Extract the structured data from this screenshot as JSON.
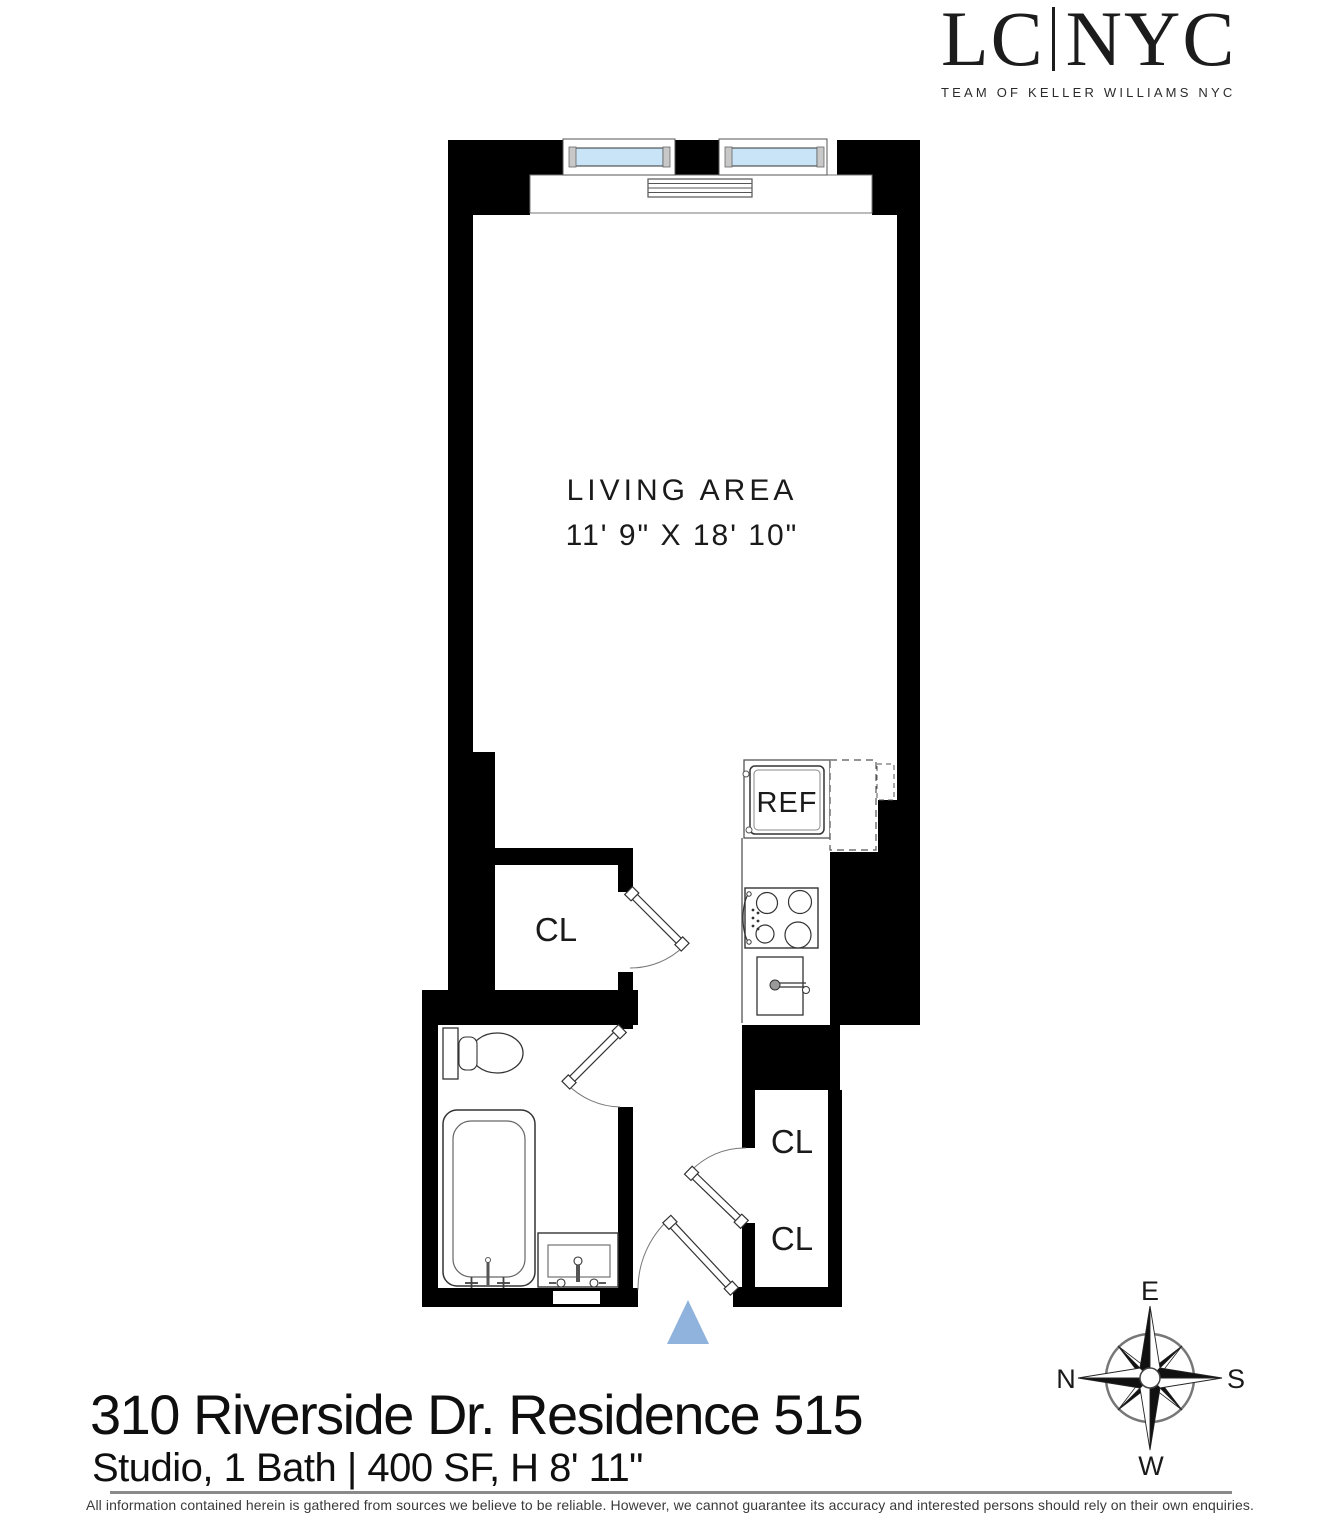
{
  "header": {
    "logo": {
      "left": "LC",
      "separator": "|",
      "right": "NYC",
      "tagline": "TEAM OF KELLER WILLIAMS NYC"
    }
  },
  "floorplan": {
    "living_area": {
      "label": "LIVING AREA",
      "dimensions": "11' 9\" X 18' 10\""
    },
    "kitchen": {
      "refrigerator": "REF"
    },
    "closets": {
      "hall": "CL",
      "entry_upper": "CL",
      "entry_lower": "CL"
    },
    "colors": {
      "wall": "#000000",
      "window_glass": "#c9e4f7",
      "entry_marker": "#8fb3dc"
    }
  },
  "compass": {
    "top": "E",
    "left": "N",
    "right": "S",
    "bottom": "W"
  },
  "listing": {
    "title": "310 Riverside Dr. Residence 515",
    "subtitle": "Studio, 1 Bath | 400 SF, H 8' 11\""
  },
  "footer": {
    "disclaimer": "All information contained herein is gathered from sources we believe to be reliable. However, we cannot guarantee its accuracy and interested persons should rely on their own enquiries."
  }
}
